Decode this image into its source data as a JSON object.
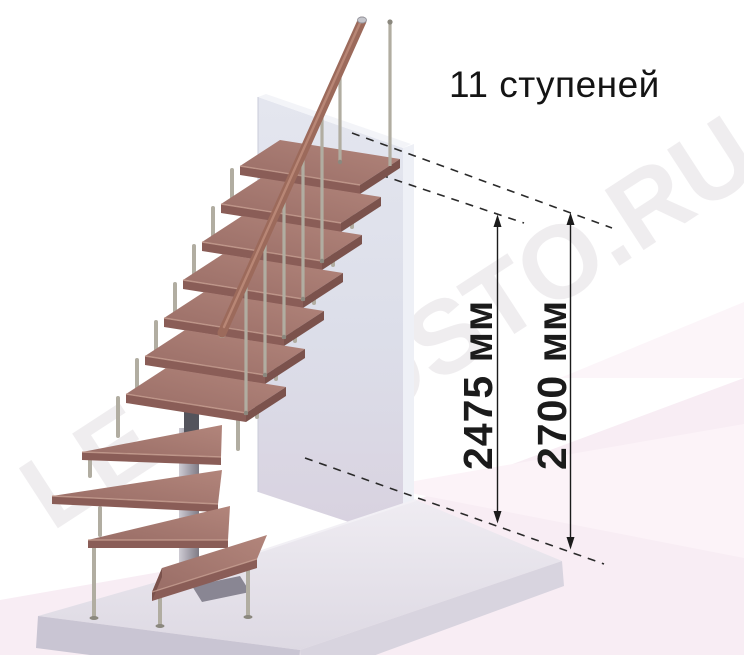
{
  "title": "11 ступеней",
  "steps_count": 11,
  "dimensions": {
    "to_top_step": {
      "label": "2475 мм",
      "value": 2475,
      "unit": "мм"
    },
    "total_height": {
      "label": "2700 мм",
      "value": 2700,
      "unit": "мм"
    }
  },
  "watermark": {
    "main": "ROSTO.RU",
    "fragment": "LE"
  },
  "colors": {
    "wood": "#a1756d",
    "wood_front": "#8a5d57",
    "wood_side": "#7b524c",
    "nosing": "#c9a193",
    "rail": "#9c6a5b",
    "metal": "#b1ada1",
    "metal_dark": "#8b887e",
    "spine": "#54545c",
    "wall": "#dfe1ea",
    "wall_side": "#eef0f6",
    "platform_top": "#e9e6ee",
    "platform_front": "#c9c5d3",
    "floor_pink": "#f8edf4",
    "annotation": "#1b1b1b"
  }
}
